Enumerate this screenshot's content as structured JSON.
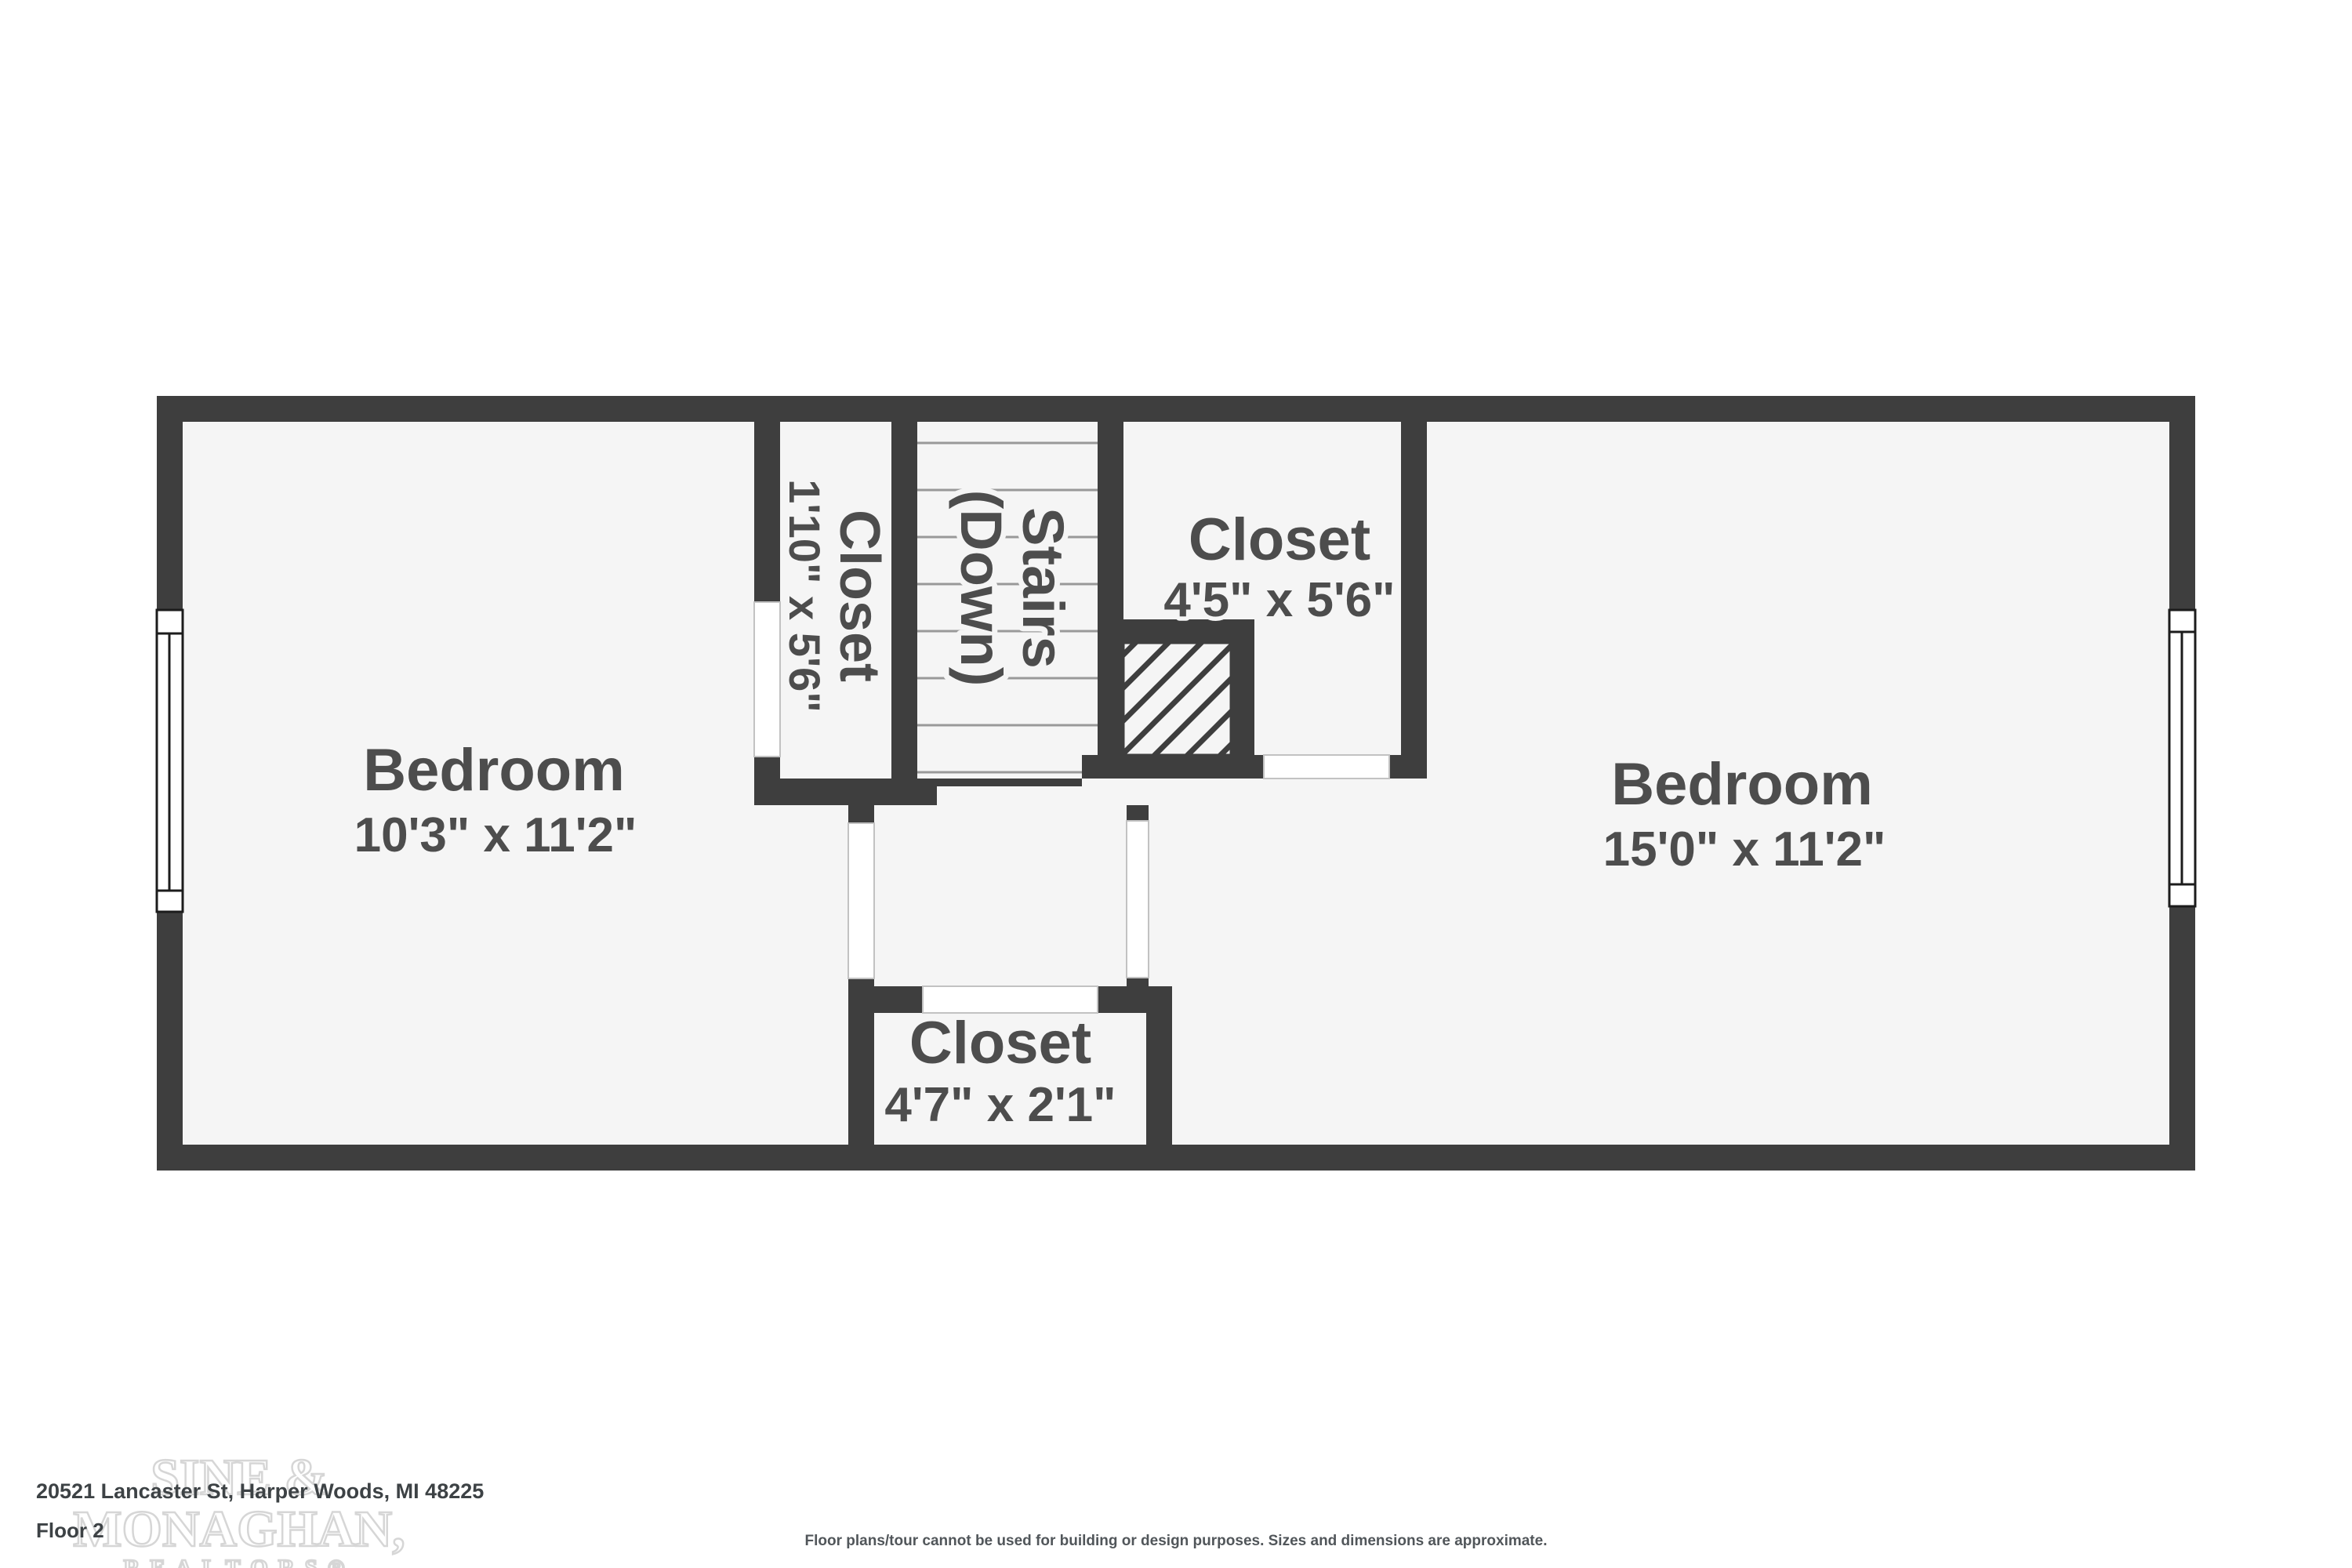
{
  "floor_plan": {
    "wall_color": "#3e3e3e",
    "floor_color": "#f5f5f5",
    "label_color": "#4d4d4d",
    "rooms": {
      "bedroom_left": {
        "name": "Bedroom",
        "dimensions": "10'3\" x 11'2\""
      },
      "bedroom_right": {
        "name": "Bedroom",
        "dimensions": "15'0\" x 11'2\""
      },
      "closet_left": {
        "name": "Closet",
        "dimensions": "1'10\" x 5'6\""
      },
      "closet_top": {
        "name": "Closet",
        "dimensions": "4'5\" x 5'6\""
      },
      "closet_bottom": {
        "name": "Closet",
        "dimensions": "4'7\" x 2'1\""
      },
      "stairs": {
        "name": "Stairs",
        "direction": "(Down)"
      }
    }
  },
  "footer": {
    "address": "20521 Lancaster St, Harper Woods, MI 48225",
    "floor_label": "Floor 2",
    "disclaimer": "Floor plans/tour cannot be used for building or design purposes. Sizes and dimensions are approximate."
  },
  "watermark": {
    "line1": "SINE &",
    "line2": "MONAGHAN,",
    "line3": "REALTORS®"
  }
}
